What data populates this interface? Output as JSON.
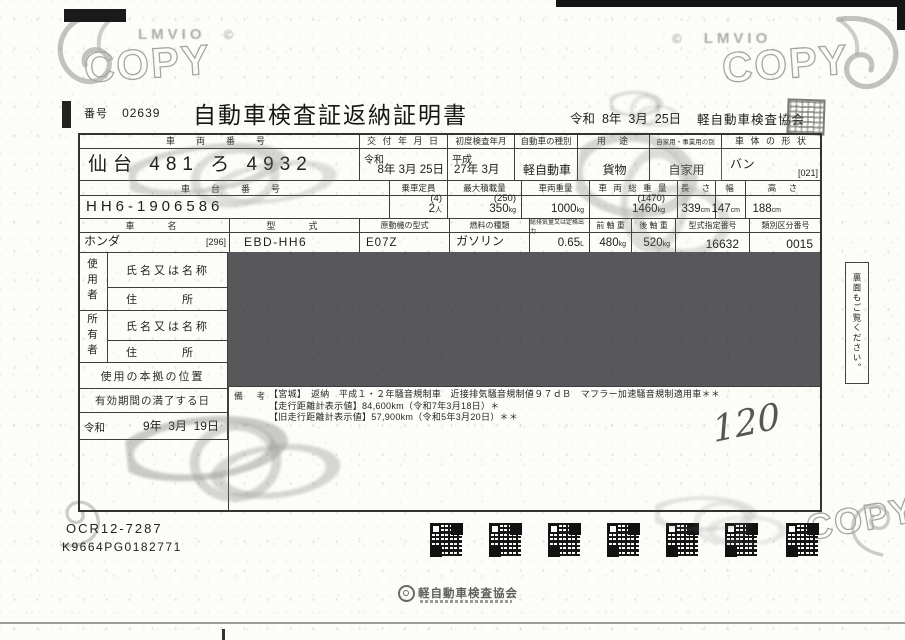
{
  "scan": {
    "copy_watermark": "COPY",
    "brand_watermark": "LMVIO",
    "copyright_mark": "©"
  },
  "header": {
    "number_label": "番号",
    "number": "02639",
    "title": "自動車検査証返納証明書",
    "issue_date_top": "令和  8年  3月  25日",
    "issuer": "軽自動車検査協会"
  },
  "table": {
    "r1_headers": {
      "plate": "車　両　番　号",
      "issue": "交 付 年 月 日",
      "first_inspection": "初度検査年月",
      "kind": "自動車の種別",
      "use": "用　途",
      "private": "自家用・事業用の別",
      "body": "車 体 の 形 状"
    },
    "r1": {
      "plate": "仙台 481 ろ 4932",
      "issue_era": "令和",
      "issue_date": "8年 3月 25日",
      "first_era": "平成",
      "first_date": "27年 3月",
      "kind": "軽自動車",
      "use": "貨物",
      "private": "自家用",
      "body": "バン",
      "body_code": "[021]"
    },
    "r2_headers": {
      "chassis": "車　台　番　号",
      "capacity": "乗車定員",
      "max_load": "最大積載量",
      "weight": "車両重量",
      "gross": "車 両 総 重 量",
      "length": "長　さ",
      "width": "幅",
      "height": "高　さ"
    },
    "r2": {
      "chassis": "HH6-1906586",
      "capacity_paren": "(4)",
      "capacity": "2",
      "capacity_unit": "人",
      "load_paren": "(250)",
      "load": "350",
      "load_unit": "kg",
      "weight": "1000",
      "weight_unit": "kg",
      "gross_paren": "(1470)",
      "gross": "1460",
      "gross_unit": "kg",
      "length": "339",
      "length_unit": "cm",
      "width": "147",
      "width_unit": "cm",
      "height": "188",
      "height_unit": "cm"
    },
    "r3_headers": {
      "make": "車　　名",
      "model": "型　　式",
      "engine": "原動機の型式",
      "fuel": "燃料の種類",
      "displacement": "総排気量又は定格出力",
      "front_axle": "前 軸 重",
      "rear_axle": "後 軸 重",
      "type_no": "型式指定番号",
      "class_no": "類別区分番号"
    },
    "r3": {
      "make": "ホンダ",
      "make_code": "[296]",
      "model": "EBD-HH6",
      "engine": "E07Z",
      "fuel": "ガソリン",
      "displacement": "0.65",
      "displacement_unit": "L",
      "front_axle": "480",
      "front_axle_unit": "kg",
      "rear_axle": "520",
      "rear_axle_unit": "kg",
      "type_no": "16632",
      "class_no": "0015"
    },
    "left": {
      "user": "使用者",
      "owner": "所有者",
      "name_label": "氏名又は名称",
      "address_label": "住　　　所",
      "base_label": "使用の本拠の位置",
      "expiry_label": "有効期間の満了する日",
      "expiry_era": "令和",
      "expiry_date": "9年  3月  19日"
    },
    "remarks_label": "備  考",
    "remarks": [
      "【宮城】　返納　平成１・２年騒音規制車　近接排気騒音規制値９７ｄＢ　マフラー加速騒音規制適用車＊＊",
      "【走行距離計表示値】84,600km（令和7年3月18日）＊",
      "【旧走行距離計表示値】57,900km（令和5年3月20日）＊＊"
    ],
    "handwritten": "120"
  },
  "side_note": "裏面もご覧ください。",
  "footer": {
    "ocr_code": "OCR12-7287",
    "serial": "K9664PG0182771",
    "org": "軽自動車検査協会"
  }
}
